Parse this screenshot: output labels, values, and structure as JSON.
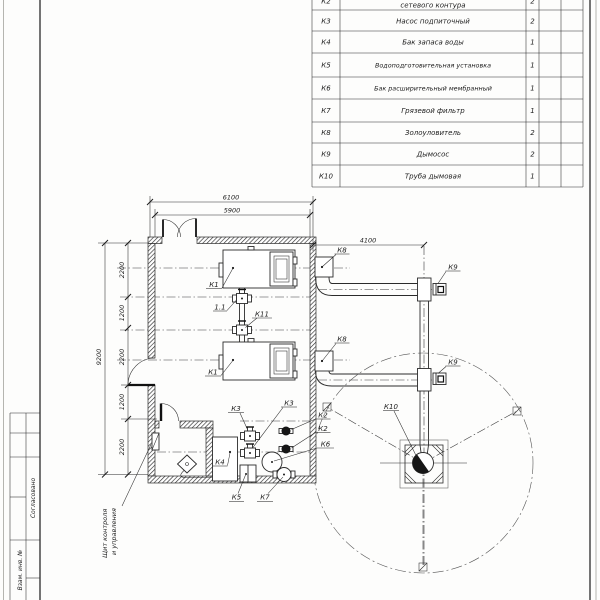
{
  "sheet": {
    "equipment_table": {
      "rows": [
        {
          "pos": "К2",
          "name": "сетевого контура",
          "qty": "2"
        },
        {
          "pos": "К3",
          "name": "Насос подпиточный",
          "qty": "2"
        },
        {
          "pos": "К4",
          "name": "Бак запаса воды",
          "qty": "1"
        },
        {
          "pos": "К5",
          "name": "Водоподготовительная установка",
          "qty": "1"
        },
        {
          "pos": "К6",
          "name": "Бак расширительный мембранный",
          "qty": "1"
        },
        {
          "pos": "К7",
          "name": "Грязевой фильтр",
          "qty": "1"
        },
        {
          "pos": "К8",
          "name": "Золоуловитель",
          "qty": "2"
        },
        {
          "pos": "К9",
          "name": "Дымосос",
          "qty": "2"
        },
        {
          "pos": "К10",
          "name": "Труба дымовая",
          "qty": "1"
        }
      ]
    },
    "dimensions": {
      "outer_width": "6100",
      "inner_width": "5900",
      "flue_offset": "4100",
      "inner_depth": "9200",
      "chain": [
        "2200",
        "1200",
        "2200",
        "1200",
        "2200"
      ]
    },
    "labels": {
      "k1": "К1",
      "p11": "1.1",
      "k11": "К11",
      "k2": "К2",
      "k3": "К3",
      "k4": "К4",
      "k5": "К5",
      "k6": "К6",
      "k7": "К7",
      "k8": "К8",
      "k9": "К9",
      "k10": "К10"
    },
    "note": {
      "line1": "Щит контроля",
      "line2": "и управления"
    },
    "stamp": {
      "agreed": "Согласовано",
      "inv": "Взам. инв. №"
    }
  }
}
